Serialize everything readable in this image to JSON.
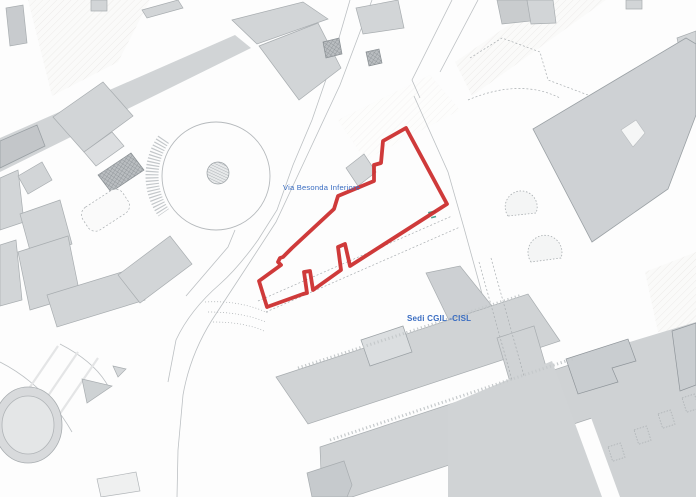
{
  "labels": {
    "street": "Via Besonda Inferiore",
    "site": "Sedi CGIL -CISL"
  },
  "colors": {
    "label_blue": "#3a6dc2",
    "boundary_red": "#cb2b2b",
    "building_gray": "#d2d5d7",
    "building_dark_gray": "#c9ccce",
    "road_gray": "#d1d4d6",
    "line_gray": "#a8adb0",
    "background": "#fdfdfd",
    "survey_teal": "#49a08e"
  }
}
